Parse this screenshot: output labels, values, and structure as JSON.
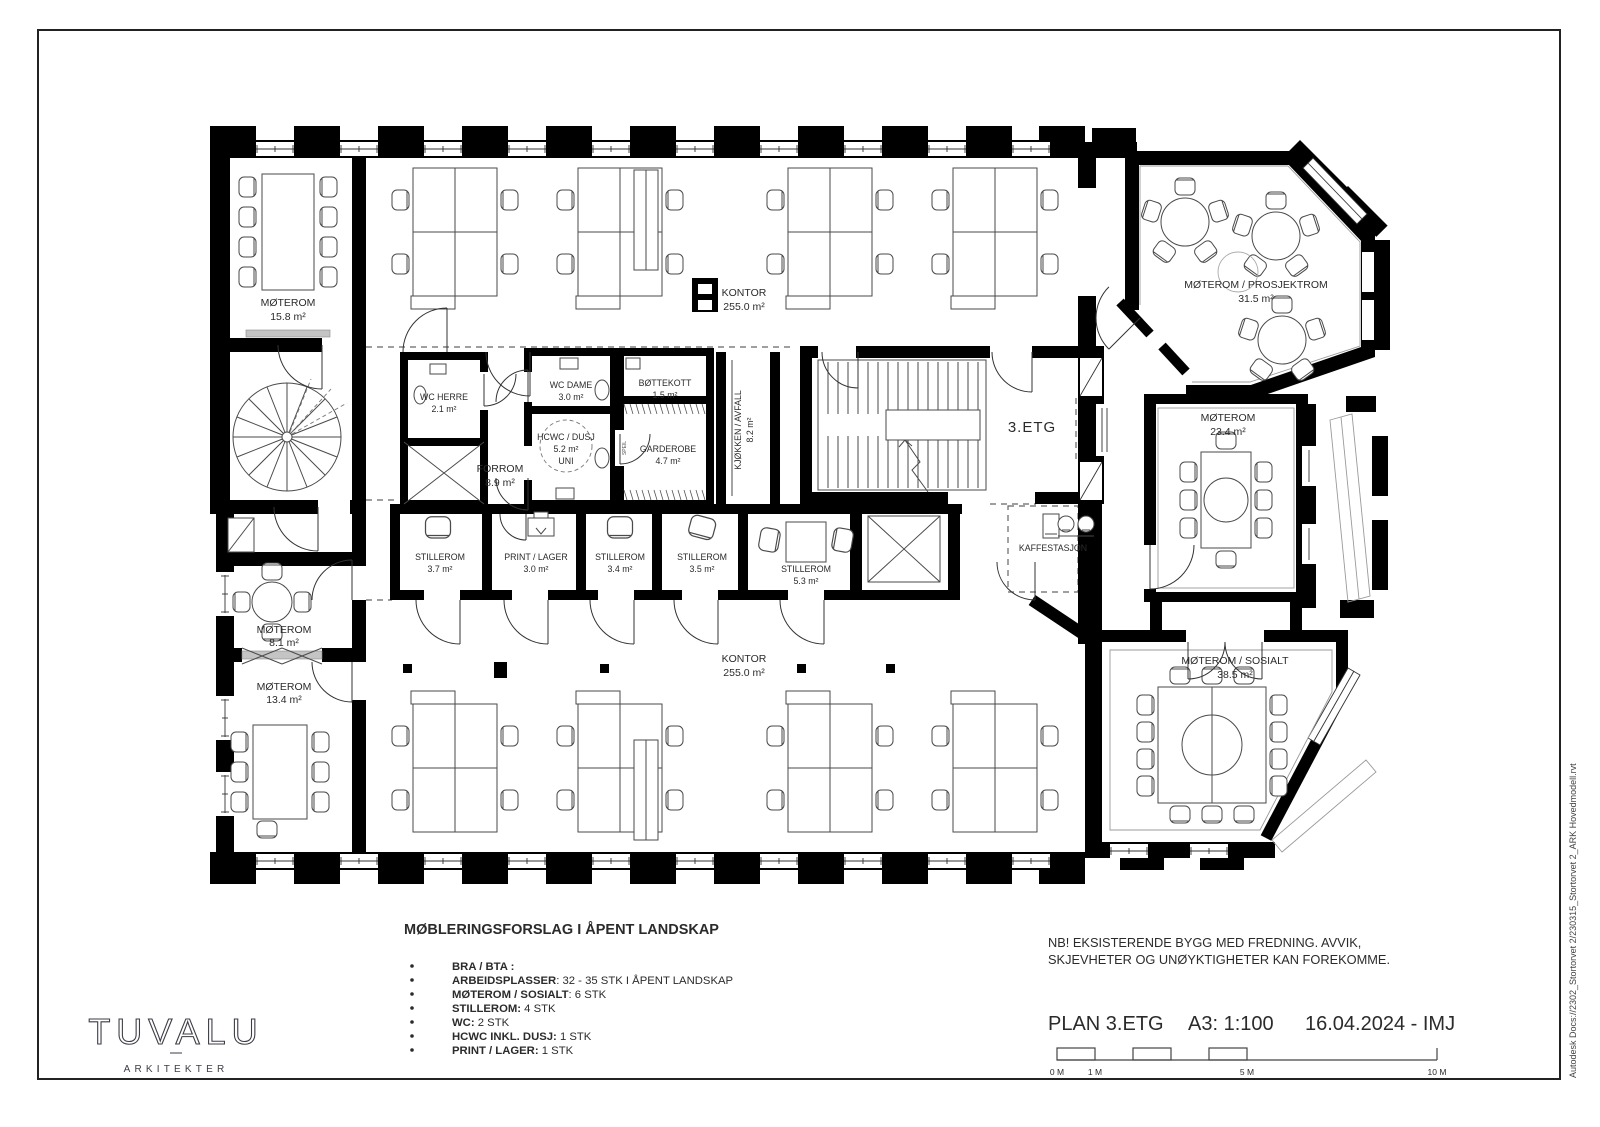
{
  "sheet": {
    "plan_title": "PLAN 3.ETG",
    "scale": "A3: 1:100",
    "date_author": "16.04.2024 - IMJ",
    "note_line1": "NB! EKSISTERENDE BYGG MED FREDNING.  AVVIK,",
    "note_line2": "SKJEVHETER OG UNØYKTIGHETER KAN FOREKOMME.",
    "side_text": "Autodesk Docs://2302_Stortorvet 2/230315_Stortorvet 2_ARK Hovedmodell.rvt",
    "scalebar": {
      "l0": "0 M",
      "l1": "1 M",
      "l5": "5 M",
      "l10": "10 M"
    }
  },
  "logo": {
    "name": "TUVALU",
    "sub": "ARKITEKTER"
  },
  "legend": {
    "title": "MØBLERINGSFORSLAG I ÅPENT LANDSKAP",
    "items": [
      {
        "bold": "BRA / BTA :",
        "rest": ""
      },
      {
        "bold": "ARBEIDSPLASSER",
        "rest": ": 32 - 35  STK I ÅPENT LANDSKAP"
      },
      {
        "bold": "MØTEROM / SOSIALT",
        "rest": ": 6 STK"
      },
      {
        "bold": "STILLEROM:",
        "rest": " 4 STK"
      },
      {
        "bold": "WC:",
        "rest": " 2 STK"
      },
      {
        "bold": "HCWC INKL. DUSJ:",
        "rest": " 1 STK"
      },
      {
        "bold": "PRINT / LAGER:",
        "rest": " 1 STK"
      }
    ]
  },
  "rooms": [
    {
      "name": "MØTEROM",
      "area": "15.8 m²"
    },
    {
      "name": "KONTOR",
      "area": "255.0 m²"
    },
    {
      "name": "MØTEROM / PROSJEKTROM",
      "area": "31.5 m²"
    },
    {
      "name": "WC HERRE",
      "area": "2.1 m²"
    },
    {
      "name": "WC DAME",
      "area": "3.0 m²"
    },
    {
      "name": "BØTTEKOTT",
      "area": "1.5 m²"
    },
    {
      "name": "HCWC / DUSJ",
      "area": "5.2 m²",
      "extra": "UNI"
    },
    {
      "name": "FORROM",
      "area": "8.9 m²"
    },
    {
      "name": "GARDEROBE",
      "area": "4.7 m²"
    },
    {
      "name": "KJØKKEN / AVFALL",
      "area": "8.2 m²"
    },
    {
      "name": "3.ETG",
      "area": ""
    },
    {
      "name": "MØTEROM",
      "area": "23.4 m²"
    },
    {
      "name": "STILLEROM",
      "area": "3.7 m²"
    },
    {
      "name": "PRINT / LAGER",
      "area": "3.0 m²"
    },
    {
      "name": "STILLEROM",
      "area": "3.4 m²"
    },
    {
      "name": "STILLEROM",
      "area": "3.5 m²"
    },
    {
      "name": "STILLEROM",
      "area": "5.3 m²"
    },
    {
      "name": "KAFFESTASJON",
      "area": ""
    },
    {
      "name": "MØTEROM / SOSIALT",
      "area": "38.5 m²"
    },
    {
      "name": "MØTEROM",
      "area": "8.1 m²"
    },
    {
      "name": "MØTEROM",
      "area": "13.4 m²"
    },
    {
      "name": "KONTOR",
      "area": "255.0 m²"
    }
  ],
  "misc": {
    "speil": "SPEIL"
  }
}
